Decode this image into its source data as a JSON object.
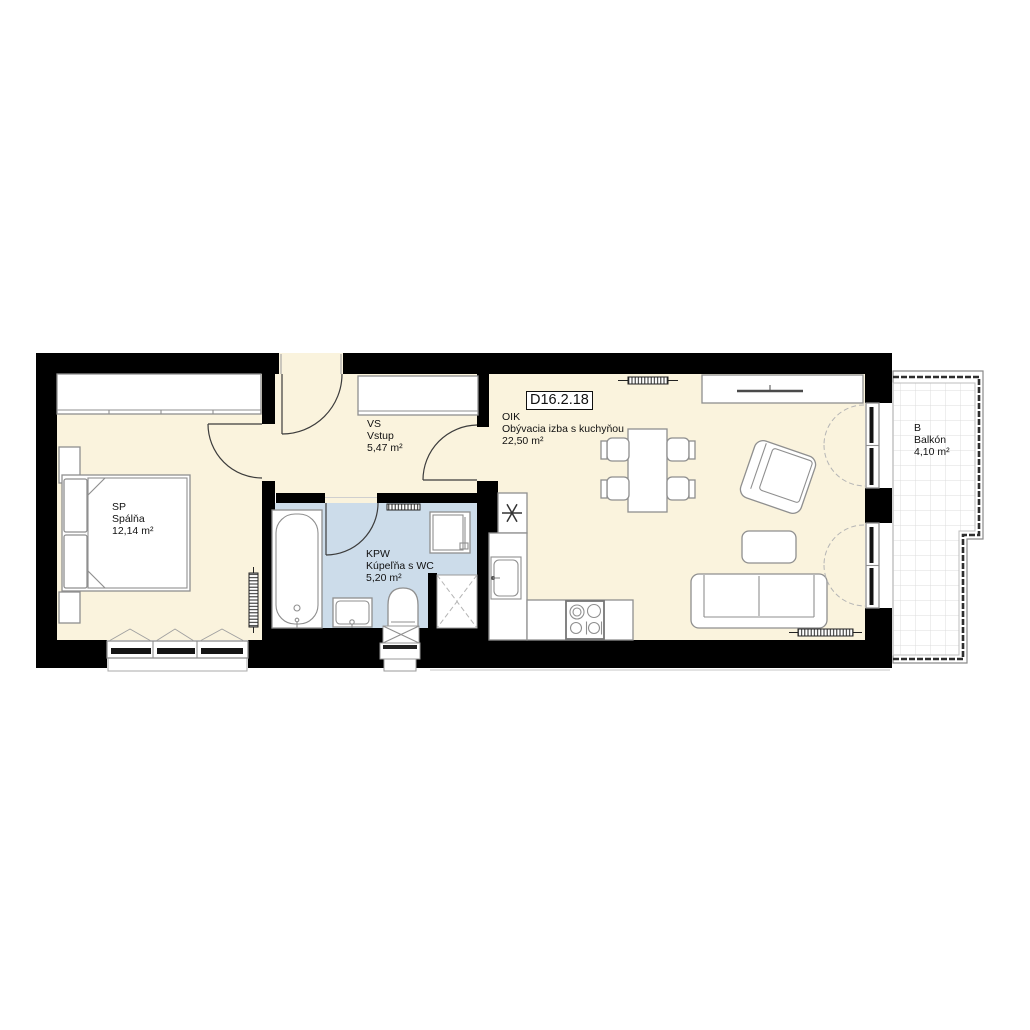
{
  "unit": {
    "id": "D16.2.18"
  },
  "rooms": [
    {
      "code": "SP",
      "name": "Spálňa",
      "area": "12,14 m²"
    },
    {
      "code": "VS",
      "name": "Vstup",
      "area": "5,47 m²"
    },
    {
      "code": "KPW",
      "name": "Kúpeľňa s WC",
      "area": "5,20 m²"
    },
    {
      "code": "OIK",
      "name": "Obývacia izba s kuchyňou",
      "area": "22,50 m²"
    },
    {
      "code": "B",
      "name": "Balkón",
      "area": "4,10 m²"
    }
  ],
  "colors": {
    "wall": "#000000",
    "floor": "#faf3dd",
    "bath-floor": "#ccdcea",
    "line": "#8f8f8f",
    "text": "#111111"
  }
}
